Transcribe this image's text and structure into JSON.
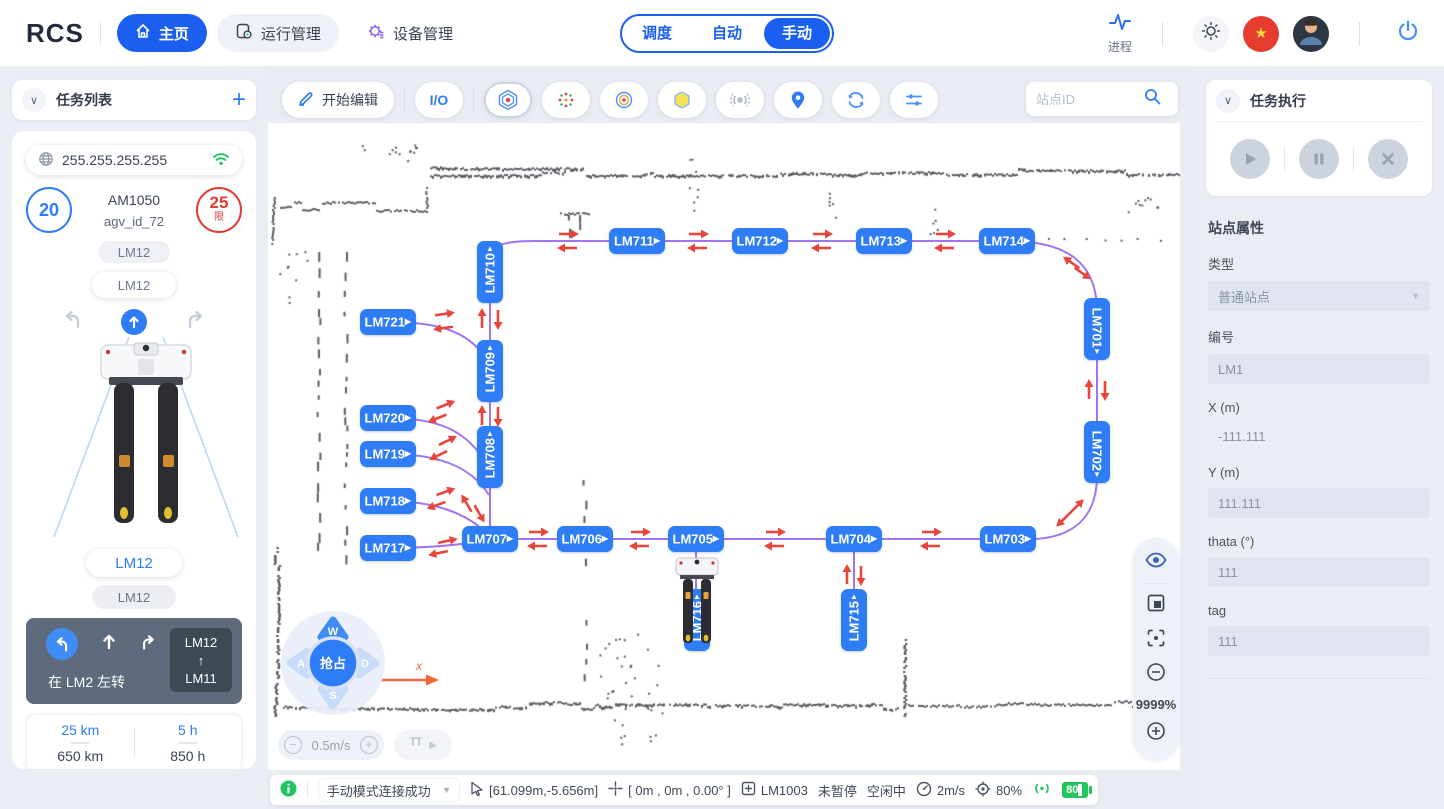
{
  "colors": {
    "primary": "#1a5ff0",
    "station": "#2e7cf6",
    "path": "#9b6df2",
    "arrow": "#e8453c",
    "green": "#21c55e",
    "danger": "#e23b30",
    "purple": "#8a5cf6"
  },
  "topbar": {
    "logo": "RCS",
    "nav": [
      {
        "label": "主页"
      },
      {
        "label": "运行管理"
      },
      {
        "label": "设备管理"
      }
    ],
    "modes": [
      {
        "label": "调度"
      },
      {
        "label": "自动"
      },
      {
        "label": "手动"
      }
    ],
    "process_label": "进程"
  },
  "left_panel": {
    "header_title": "任务列表",
    "ip": "255.255.255.255",
    "speed_value": "20",
    "model": "AM1050",
    "agv_id": "agv_id_72",
    "limit_value": "25",
    "limit_suffix": "限",
    "chip_top1": "LM12",
    "chip_top2": "LM12",
    "chip_bottom1": "LM12",
    "chip_bottom2": "LM12",
    "nav_hint": "在 LM2 左转",
    "route_from": "LM12",
    "route_arrow": "↑",
    "route_to": "LM11",
    "stats": [
      {
        "top": "25 km",
        "bottom": "650 km"
      },
      {
        "top": "5 h",
        "bottom": "850 h"
      }
    ]
  },
  "toolbar": {
    "edit_label": "开始编辑",
    "io_label": "I/O",
    "search_placeholder": "站点ID"
  },
  "map": {
    "stations": [
      {
        "id": "LM710",
        "x": 222,
        "y": 205,
        "o": "vu"
      },
      {
        "id": "LM709",
        "x": 222,
        "y": 304,
        "o": "vu"
      },
      {
        "id": "LM708",
        "x": 222,
        "y": 390,
        "o": "vu"
      },
      {
        "id": "LM711",
        "x": 369,
        "y": 174,
        "o": "h"
      },
      {
        "id": "LM712",
        "x": 492,
        "y": 174,
        "o": "h"
      },
      {
        "id": "LM713",
        "x": 616,
        "y": 174,
        "o": "h"
      },
      {
        "id": "LM714",
        "x": 739,
        "y": 174,
        "o": "h"
      },
      {
        "id": "LM701",
        "x": 829,
        "y": 262,
        "o": "vd"
      },
      {
        "id": "LM702",
        "x": 829,
        "y": 385,
        "o": "vd"
      },
      {
        "id": "LM703",
        "x": 740,
        "y": 472,
        "o": "h"
      },
      {
        "id": "LM704",
        "x": 586,
        "y": 472,
        "o": "h"
      },
      {
        "id": "LM705",
        "x": 428,
        "y": 472,
        "o": "h"
      },
      {
        "id": "LM706",
        "x": 317,
        "y": 472,
        "o": "h"
      },
      {
        "id": "LM707",
        "x": 222,
        "y": 472,
        "o": "h"
      },
      {
        "id": "LM721",
        "x": 120,
        "y": 255,
        "o": "h"
      },
      {
        "id": "LM720",
        "x": 120,
        "y": 351,
        "o": "h"
      },
      {
        "id": "LM719",
        "x": 120,
        "y": 387,
        "o": "h"
      },
      {
        "id": "LM718",
        "x": 120,
        "y": 434,
        "o": "h"
      },
      {
        "id": "LM717",
        "x": 120,
        "y": 481,
        "o": "h"
      },
      {
        "id": "LM716",
        "x": 429,
        "y": 553,
        "o": "vu"
      },
      {
        "id": "LM715",
        "x": 586,
        "y": 553,
        "o": "vu"
      }
    ],
    "arrows": [
      {
        "x": 300,
        "y": 167,
        "a": 0
      },
      {
        "x": 300,
        "y": 181,
        "a": 180
      },
      {
        "x": 430,
        "y": 167,
        "a": 0
      },
      {
        "x": 430,
        "y": 181,
        "a": 180
      },
      {
        "x": 554,
        "y": 167,
        "a": 0
      },
      {
        "x": 554,
        "y": 181,
        "a": 180
      },
      {
        "x": 677,
        "y": 167,
        "a": 0
      },
      {
        "x": 677,
        "y": 181,
        "a": 180
      },
      {
        "x": 804,
        "y": 196,
        "a": 215
      },
      {
        "x": 814,
        "y": 206,
        "a": 35
      },
      {
        "x": 821,
        "y": 323,
        "a": 270
      },
      {
        "x": 837,
        "y": 323,
        "a": 90
      },
      {
        "x": 808,
        "y": 440,
        "a": 315
      },
      {
        "x": 796,
        "y": 452,
        "a": 135
      },
      {
        "x": 663,
        "y": 465,
        "a": 0
      },
      {
        "x": 663,
        "y": 479,
        "a": 180
      },
      {
        "x": 507,
        "y": 465,
        "a": 0
      },
      {
        "x": 507,
        "y": 479,
        "a": 180
      },
      {
        "x": 372,
        "y": 465,
        "a": 0
      },
      {
        "x": 372,
        "y": 479,
        "a": 180
      },
      {
        "x": 270,
        "y": 465,
        "a": 0
      },
      {
        "x": 270,
        "y": 479,
        "a": 180
      },
      {
        "x": 579,
        "y": 508,
        "a": 270
      },
      {
        "x": 593,
        "y": 508,
        "a": 90
      },
      {
        "x": 421,
        "y": 502,
        "a": 270
      },
      {
        "x": 435,
        "y": 502,
        "a": 90
      },
      {
        "x": 214,
        "y": 252,
        "a": 270
      },
      {
        "x": 230,
        "y": 252,
        "a": 90
      },
      {
        "x": 214,
        "y": 349,
        "a": 270
      },
      {
        "x": 230,
        "y": 349,
        "a": 90
      },
      {
        "x": 199,
        "y": 437,
        "a": 240
      },
      {
        "x": 211,
        "y": 446,
        "a": 60
      },
      {
        "x": 176,
        "y": 247,
        "a": -8
      },
      {
        "x": 176,
        "y": 261,
        "a": 172
      },
      {
        "x": 177,
        "y": 338,
        "a": -22
      },
      {
        "x": 170,
        "y": 351,
        "a": 158
      },
      {
        "x": 179,
        "y": 374,
        "a": -26
      },
      {
        "x": 171,
        "y": 388,
        "a": 154
      },
      {
        "x": 177,
        "y": 425,
        "a": -20
      },
      {
        "x": 169,
        "y": 438,
        "a": 160
      },
      {
        "x": 179,
        "y": 474,
        "a": -12
      },
      {
        "x": 171,
        "y": 486,
        "a": 168
      }
    ],
    "joystick": {
      "up": "W",
      "left": "A",
      "right": "D",
      "down": "S",
      "center": "抢占"
    },
    "axis_label": "x",
    "zoom_percent": "9999%",
    "speed_value": "0.5m/s"
  },
  "right_panel": {
    "exec_title": "任务执行",
    "props_title": "站点属性",
    "fields": [
      {
        "label": "类型",
        "value": "普通站点"
      },
      {
        "label": "编号",
        "value": "LM1"
      },
      {
        "label": "X (m)",
        "value": "-111.111"
      },
      {
        "label": "Y (m)",
        "value": "111.111"
      },
      {
        "label": "thata (°)",
        "value": "111"
      },
      {
        "label": "tag",
        "value": "111"
      }
    ]
  },
  "statusbar": {
    "message": "手动模式连接成功",
    "cursor_pos": "[61.099m,-5.656m]",
    "robot_pose": "[ 0m , 0m , 0.00° ]",
    "station": "LM1003",
    "pause_state": "未暂停",
    "idle_state": "空闲中",
    "speed": "2m/s",
    "confidence": "80%",
    "battery": "80"
  }
}
